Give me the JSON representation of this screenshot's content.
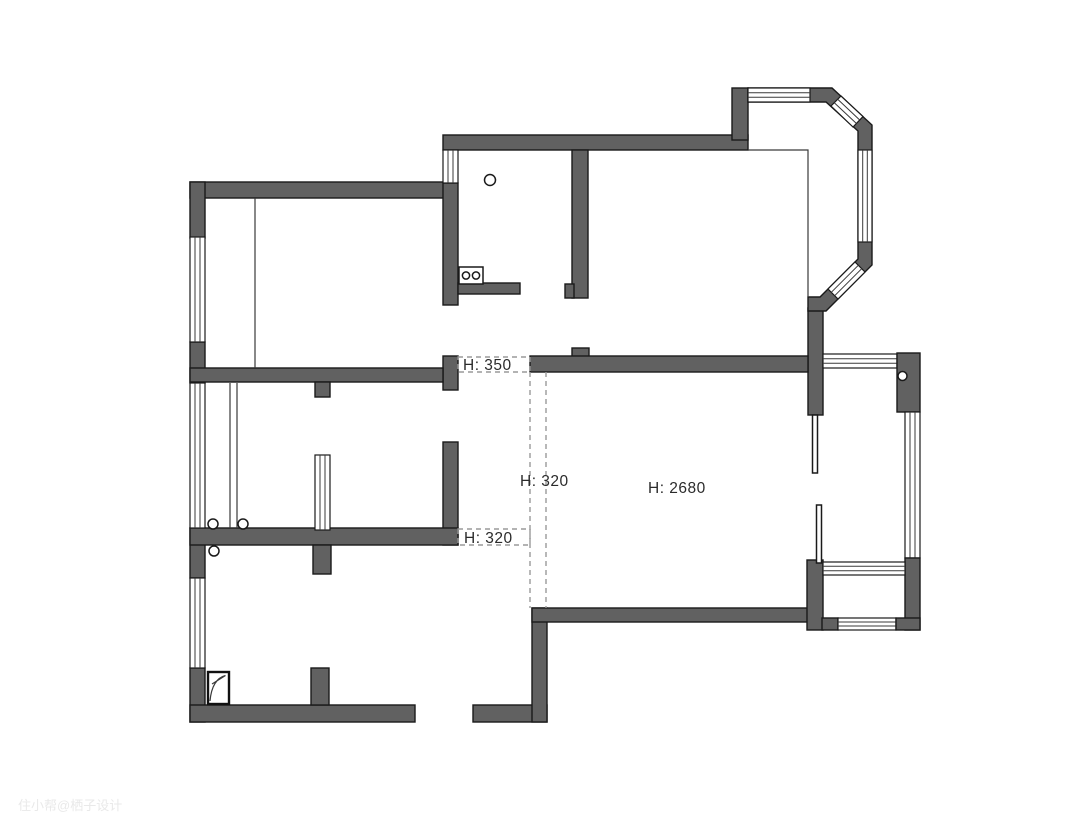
{
  "meta": {
    "type": "apartment-floor-plan",
    "description": "Black-and-white architectural floor plan with gray filled walls, hatched window symbols, an octagonal bay window (top right), a long side balcony (right), dashed ceiling-beam lines and beam/ceiling height annotations."
  },
  "canvas": {
    "width": 1080,
    "height": 836,
    "background": "#ffffff"
  },
  "colors": {
    "wall_fill": "#616161",
    "wall_stroke": "#1a1a1a",
    "thin_line": "#3a3a3a",
    "dashed_line": "#9a9a9a",
    "label_text": "#2b2b2b",
    "watermark_text": "#e9e9e9"
  },
  "labels": {
    "h350_opening": {
      "text": "H: 350"
    },
    "h320_beam": {
      "text": "H: 320"
    },
    "h2680_ceiling": {
      "text": "H: 2680"
    },
    "h320_opening": {
      "text": "H: 320"
    }
  },
  "watermark": {
    "text": "住小帮@栖子设计"
  },
  "symbols": [
    "window-hatch",
    "bay-window",
    "balcony-window",
    "sliding-door-leaves",
    "stove-two-burners",
    "sink-drain-circle",
    "floor-drain-circle",
    "door-hinge-circles",
    "shower-tray-square",
    "beam-dashed-lines",
    "closet-partition-line",
    "glass-partition-double-line"
  ]
}
